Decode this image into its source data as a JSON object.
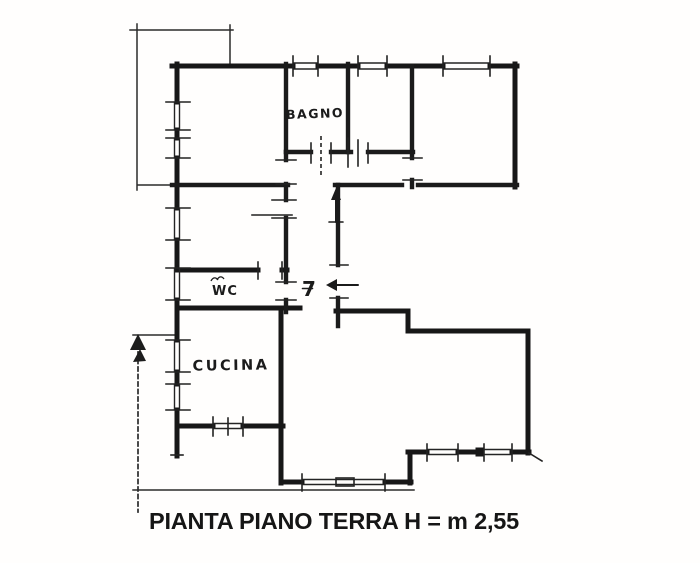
{
  "page": {
    "background": "#ffffff",
    "ink_color": "#1a1a1a"
  },
  "plan": {
    "caption": "PIANTA PIANO TERRA H = m 2,55",
    "height_note": "H = m 2,55",
    "floor_name": "PIANTA PIANO TERRA",
    "rooms": [
      {
        "name": "bagno",
        "label": "BAGNO"
      },
      {
        "name": "wc",
        "label": "WC"
      },
      {
        "name": "cucina",
        "label": "CUCINA"
      }
    ],
    "entrance": {
      "number_label": "7",
      "direction": "left"
    }
  }
}
